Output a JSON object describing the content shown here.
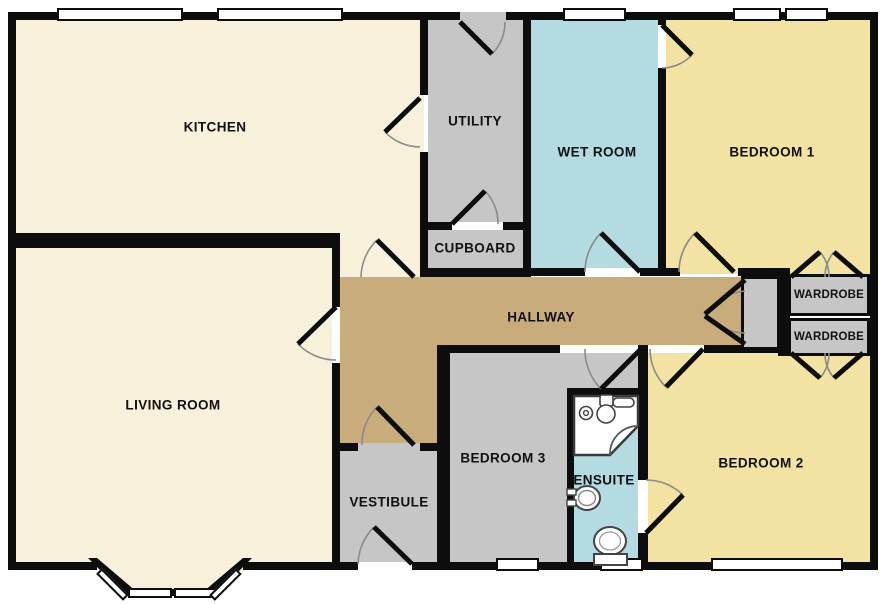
{
  "title": "Bungalow floor plan",
  "palette": {
    "cream": "#F7F1DC",
    "gray": "#C6C6C6",
    "blue": "#B5DBE2",
    "yellow": "#F2E3A2",
    "tan": "#C8AC7C",
    "wall": "#0D0D0D"
  },
  "rooms": {
    "kitchen": {
      "label": "KITCHEN"
    },
    "utility": {
      "label": "UTILITY"
    },
    "wet_room": {
      "label": "WET ROOM"
    },
    "bedroom1": {
      "label": "BEDROOM 1"
    },
    "cupboard": {
      "label": "CUPBOARD"
    },
    "hallway": {
      "label": "HALLWAY"
    },
    "wardrobe_top": {
      "label": "WARDROBE"
    },
    "wardrobe_bottom": {
      "label": "WARDROBE"
    },
    "living_room": {
      "label": "LIVING ROOM"
    },
    "vestibule": {
      "label": "VESTIBULE"
    },
    "bedroom3": {
      "label": "BEDROOM 3"
    },
    "ensuite": {
      "label": "ENSUITE"
    },
    "bedroom2": {
      "label": "BEDROOM 2"
    }
  },
  "fixtures": {
    "shower": "corner-shower",
    "sink": "wash-basin",
    "toilet": "toilet"
  }
}
